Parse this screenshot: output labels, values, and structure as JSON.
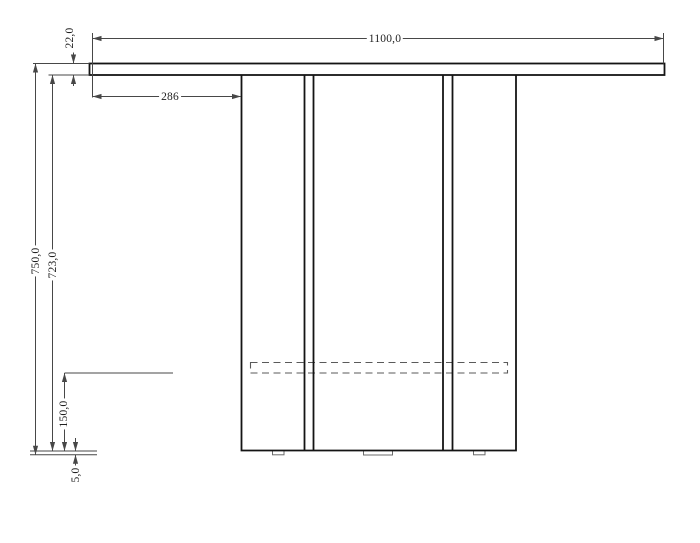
{
  "drawing": {
    "kind": "technical-dimension-drawing",
    "colors": {
      "background": "#ffffff",
      "object_line": "#141414",
      "dimension_line": "#474747",
      "hidden_line": "#5a5a5a",
      "text": "#1f1f1f"
    },
    "dimensions": {
      "tabletop_width": "1100,0",
      "tabletop_thickness": "22,0",
      "tabletop_overhang_left": "286",
      "overall_height": "750,0",
      "base_height": "723,0",
      "stretcher_offset": "150,0",
      "foot_height": "5,0"
    }
  }
}
